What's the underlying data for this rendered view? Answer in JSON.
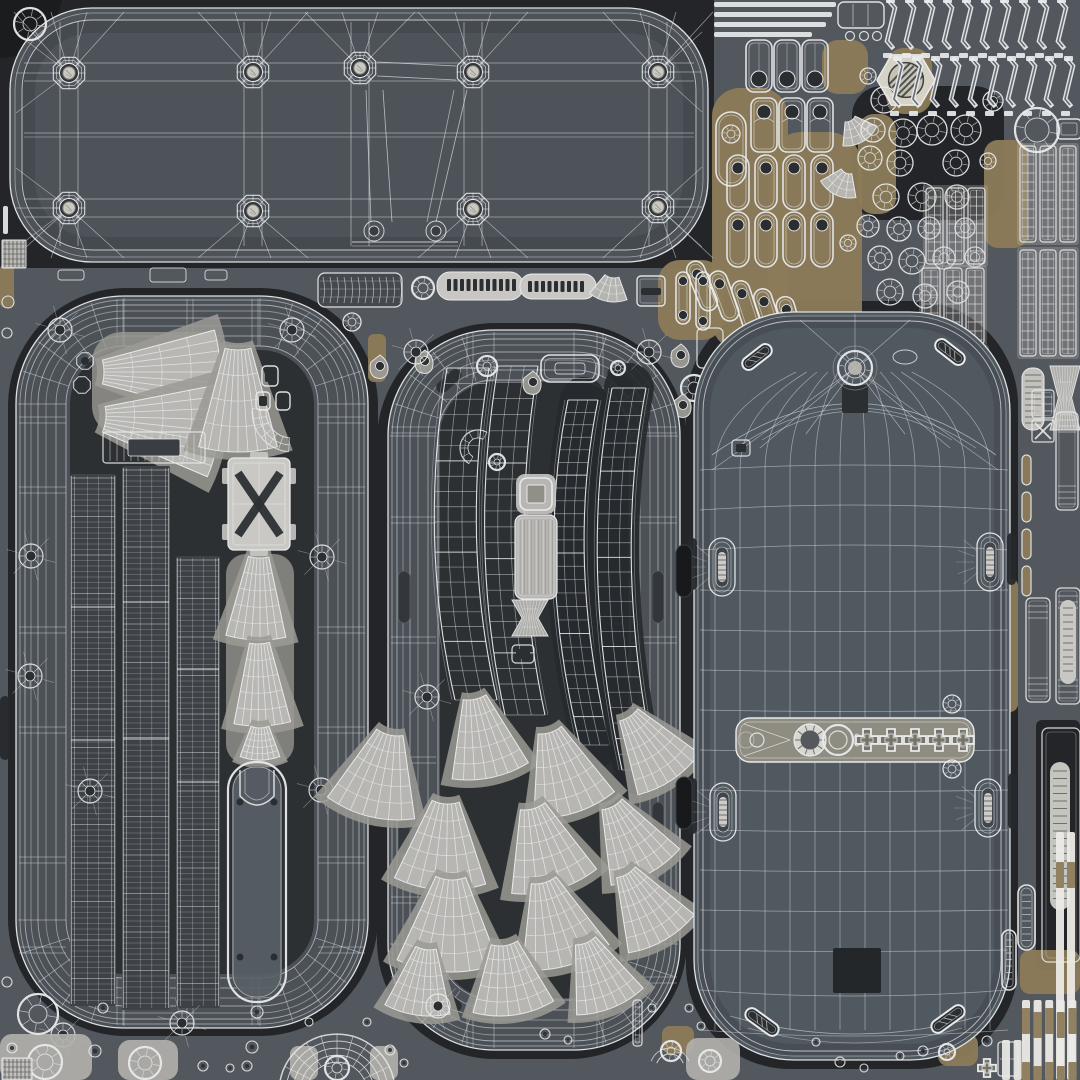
{
  "canvas": {
    "w": 1080,
    "h": 1080
  },
  "palette": {
    "bg": "#53585e",
    "grout": "#232528",
    "groutDeep": "#1a1c1e",
    "band": "#4b5157",
    "interior": "#2d3033",
    "plate": "#4d5359",
    "plateEdge": "#3f4449",
    "shell": "#515960",
    "line": "#e8eaeb",
    "light": "#c8c7c3",
    "mid": "#a8a7a3",
    "patch": "#9b9a94",
    "tan": "#8c7b59",
    "tanDark": "#6f6349",
    "warm": "#8f8c82",
    "mark": "#2c2f32",
    "metal": "#c9c8c1",
    "dark": "#26292c"
  },
  "underlays": [
    [
      0,
      0,
      714,
      268,
      0
    ],
    [
      8,
      288,
      370,
      748,
      118
    ],
    [
      377,
      323,
      310,
      736,
      118
    ],
    [
      686,
      301,
      332,
      768,
      104
    ],
    [
      852,
      86,
      152,
      134,
      30
    ],
    [
      1036,
      720,
      44,
      250,
      6
    ]
  ],
  "tanPatches": [
    [
      712,
      88,
      76,
      262,
      28
    ],
    [
      768,
      132,
      94,
      214,
      34
    ],
    [
      822,
      40,
      46,
      54,
      16
    ],
    [
      858,
      114,
      38,
      100,
      16
    ],
    [
      886,
      48,
      46,
      66,
      18
    ],
    [
      984,
      140,
      44,
      108,
      14
    ],
    [
      658,
      260,
      66,
      80,
      22
    ],
    [
      254,
      316,
      60,
      18,
      8
    ],
    [
      78,
      320,
      38,
      16,
      6
    ],
    [
      1016,
      144,
      12,
      98,
      5
    ],
    [
      998,
      578,
      20,
      134,
      8
    ],
    [
      1020,
      950,
      60,
      44,
      10
    ],
    [
      938,
      1034,
      40,
      32,
      10
    ],
    [
      662,
      1026,
      32,
      28,
      8
    ],
    [
      238,
      738,
      20,
      32,
      6
    ],
    [
      0,
      264,
      14,
      44,
      5
    ],
    [
      368,
      334,
      18,
      48,
      6
    ]
  ],
  "plate": {
    "rect": [
      10,
      8,
      698,
      254,
      82
    ],
    "bossTop": [
      [
        69,
        73
      ],
      [
        253,
        72
      ],
      [
        360,
        68
      ],
      [
        473,
        72
      ],
      [
        658,
        72
      ]
    ],
    "bossBot": [
      [
        69,
        208
      ],
      [
        253,
        211
      ],
      [
        473,
        209
      ],
      [
        658,
        207
      ]
    ],
    "bumps": [
      [
        374,
        231
      ],
      [
        436,
        231
      ]
    ],
    "cornerDonut": [
      30,
      24
    ]
  },
  "topRight": {
    "bars": [
      [
        714,
        2,
        122
      ],
      [
        714,
        12,
        118
      ],
      [
        714,
        22,
        112
      ],
      [
        714,
        32,
        98
      ]
    ],
    "barFrame": [
      838,
      2,
      46,
      26
    ],
    "barCircles": [
      [
        850,
        36
      ],
      [
        864,
        36
      ],
      [
        877,
        36
      ]
    ],
    "framesA": [
      [
        746,
        40
      ],
      [
        774,
        40
      ],
      [
        802,
        40
      ]
    ],
    "framesB": [
      [
        751,
        98
      ],
      [
        779,
        98
      ],
      [
        807,
        98
      ]
    ],
    "capCols": [
      727,
      755,
      783,
      811
    ],
    "capY": 155,
    "tilted": [
      [
        702,
        286,
        -22
      ],
      [
        724,
        296,
        -20
      ],
      [
        746,
        306,
        -18
      ],
      [
        768,
        314,
        -18
      ],
      [
        790,
        322,
        -16
      ]
    ],
    "bigCapsule": [
      716,
      112,
      30,
      74
    ],
    "hex": [
      906,
      80,
      29
    ],
    "fanQuads": [
      [
        846,
        112
      ],
      [
        850,
        164
      ]
    ],
    "rings": [
      [
        884,
        100,
        13
      ],
      [
        873,
        130,
        12
      ],
      [
        903,
        133,
        14
      ],
      [
        870,
        158,
        12
      ],
      [
        900,
        163,
        13
      ],
      [
        932,
        130,
        15
      ],
      [
        966,
        130,
        15
      ],
      [
        956,
        163,
        13
      ],
      [
        922,
        197,
        14
      ],
      [
        886,
        197,
        13
      ],
      [
        957,
        197,
        12
      ],
      [
        993,
        101,
        10
      ],
      [
        988,
        161,
        8
      ],
      [
        868,
        76,
        8
      ],
      [
        868,
        226,
        11
      ],
      [
        899,
        229,
        12
      ],
      [
        929,
        228,
        11
      ],
      [
        965,
        228,
        10
      ],
      [
        880,
        258,
        12
      ],
      [
        912,
        261,
        13
      ],
      [
        944,
        258,
        11
      ],
      [
        975,
        257,
        10
      ],
      [
        890,
        292,
        13
      ],
      [
        925,
        296,
        12
      ],
      [
        958,
        292,
        11
      ],
      [
        848,
        243,
        8
      ]
    ],
    "zigRows": [
      [
        890,
        2,
        54
      ],
      [
        897,
        60,
        112
      ]
    ],
    "zigStep": 19,
    "zigXmax": 1075,
    "ladders": [
      [
        926,
        188,
        3,
        17,
        76
      ],
      [
        922,
        268,
        3,
        18,
        76
      ],
      [
        1020,
        146,
        3,
        16,
        96
      ],
      [
        1020,
        250,
        3,
        16,
        106
      ],
      [
        924,
        348,
        3,
        18,
        60
      ]
    ],
    "bigRing": [
      1037,
      130,
      22,
      12
    ],
    "ringFrame": [
      1057,
      119,
      24,
      20
    ]
  },
  "midStrip": {
    "cyl": [
      318,
      273,
      84,
      34
    ],
    "donut": [
      352,
      322,
      9,
      4
    ],
    "ring": [
      423,
      288,
      11,
      5
    ],
    "ruler": {
      "lobe1": [
        437,
        272,
        86,
        28
      ],
      "lobe2": [
        520,
        274,
        76,
        25
      ],
      "t1x": 447,
      "t1n": 11,
      "t2x": 528,
      "t2n": 9
    },
    "fan": [
      614,
      264,
      14,
      38,
      60,
      10
    ],
    "frame": [
      637,
      276,
      28,
      30
    ],
    "tallCaps": [
      [
        676,
        272,
        14,
        52
      ],
      [
        696,
        272,
        14,
        58
      ]
    ],
    "gapFrame": [
      697,
      328,
      26,
      40
    ],
    "gapRing": [
      694,
      388,
      13,
      6
    ],
    "gapTears": [
      [
        681,
        357
      ],
      [
        683,
        407
      ]
    ]
  },
  "left": {
    "band": [
      16,
      296,
      352,
      732,
      108
    ],
    "bandW": 54,
    "wings": [
      [
        58,
        372,
        46,
        162,
        30,
        -90
      ],
      [
        62,
        415,
        44,
        158,
        34,
        -84
      ],
      [
        238,
        300,
        50,
        152,
        30,
        0
      ]
    ],
    "wingPatch": [
      92,
      332,
      136,
      104,
      30
    ],
    "buttons": [
      [
        262,
        366,
        16,
        20
      ],
      [
        256,
        392,
        14,
        18
      ],
      [
        276,
        392,
        14,
        18
      ]
    ],
    "arcLadder": [
      292,
      412
    ],
    "ladderRect": [
      103,
      432,
      102,
      31
    ],
    "ladderDark": [
      128,
      439,
      52,
      17
    ],
    "xPlate": [
      228,
      458,
      62,
      92
    ],
    "cones": [
      [
        260,
        516,
        42,
        124,
        28,
        2
      ],
      [
        258,
        600,
        44,
        126,
        26,
        -2
      ],
      [
        260,
        702,
        26,
        58,
        40,
        0
      ]
    ],
    "conePatch": [
      226,
      554,
      68,
      210,
      20
    ],
    "battery": [
      228,
      762,
      58,
      240
    ],
    "strips": [
      [
        70,
        474,
        46,
        532
      ],
      [
        122,
        466,
        48,
        544
      ],
      [
        176,
        556,
        44,
        452
      ]
    ],
    "bosses": [
      [
        31,
        556
      ],
      [
        30,
        676
      ],
      [
        90,
        791
      ],
      [
        322,
        557
      ],
      [
        321,
        790
      ],
      [
        60,
        330
      ],
      [
        292,
        330
      ],
      [
        182,
        1023
      ],
      [
        63,
        1035
      ]
    ],
    "octs": [
      [
        85,
        361
      ],
      [
        82,
        385
      ]
    ],
    "ticksY": [
      420,
      490,
      630,
      730,
      860,
      950
    ],
    "ticksX": [
      120,
      190,
      255
    ]
  },
  "center": {
    "band": [
      388,
      330,
      292,
      720,
      106
    ],
    "bandW": 52,
    "slots": [
      [
        398,
        571,
        12,
        52
      ],
      [
        652,
        571,
        12,
        52
      ],
      [
        398,
        802,
        12,
        52
      ],
      [
        652,
        802,
        12,
        52
      ]
    ],
    "cornerSlots": [
      [
        449,
        381,
        -42
      ],
      [
        620,
        379,
        42
      ],
      [
        449,
        1000,
        42
      ],
      [
        620,
        998,
        -42
      ]
    ],
    "bananas": [
      [
        447,
        368,
        418,
        540,
        455,
        700,
        42,
        22,
        0
      ],
      [
        498,
        366,
        468,
        545,
        505,
        715,
        40,
        22,
        0
      ],
      [
        568,
        400,
        535,
        560,
        580,
        745,
        30,
        26,
        1
      ],
      [
        612,
        388,
        578,
        565,
        622,
        770,
        34,
        26,
        1
      ]
    ],
    "topFrame": [
      541,
      355,
      58,
      27
    ],
    "topCircles": [
      [
        487,
        366,
        10,
        4
      ],
      [
        618,
        368,
        7,
        3
      ],
      [
        497,
        462,
        8,
        3
      ]
    ],
    "tears": [
      [
        425,
        363
      ],
      [
        533,
        384
      ],
      [
        380,
        368
      ]
    ],
    "cArc": [
      478,
      448
    ],
    "sqFrame": [
      520,
      478,
      32,
      32
    ],
    "lightRect": [
      515,
      515,
      42,
      84
    ],
    "hourglass": [
      512,
      600,
      36,
      36
    ],
    "smallFrame": [
      512,
      645,
      22,
      18
    ],
    "fans": [
      [
        468,
        666,
        34,
        114,
        40,
        -12
      ],
      [
        398,
        700,
        36,
        120,
        44,
        14
      ],
      [
        540,
        700,
        34,
        118,
        42,
        -18
      ],
      [
        612,
        690,
        32,
        108,
        40,
        -34
      ],
      [
        448,
        768,
        36,
        122,
        44,
        4
      ],
      [
        524,
        776,
        34,
        118,
        44,
        -16
      ],
      [
        598,
        778,
        32,
        108,
        42,
        -28
      ],
      [
        452,
        842,
        38,
        130,
        46,
        2
      ],
      [
        535,
        850,
        34,
        120,
        44,
        -16
      ],
      [
        612,
        848,
        30,
        106,
        42,
        -30
      ],
      [
        500,
        912,
        34,
        104,
        46,
        -8
      ],
      [
        575,
        915,
        30,
        100,
        42,
        -22
      ],
      [
        430,
        920,
        30,
        96,
        40,
        8
      ]
    ],
    "bosses": [
      [
        416,
        352
      ],
      [
        649,
        352
      ],
      [
        427,
        697
      ],
      [
        438,
        1006
      ]
    ],
    "ticksY": [
      430,
      520,
      640,
      760,
      900,
      980
    ]
  },
  "right": {
    "shell": [
      694,
      312,
      316,
      748,
      100
    ],
    "gridX": [
      715,
      740,
      765,
      790,
      815,
      840,
      865,
      890,
      915,
      940,
      965,
      990
    ],
    "gridY0": 470,
    "gridY1": 1030,
    "gridStep": 40,
    "domeC": [
      855,
      368
    ],
    "topSlots": [
      [
        757,
        357,
        -38
      ],
      [
        950,
        352,
        38
      ]
    ],
    "topOval": [
      905,
      357,
      12,
      7
    ],
    "darkSq": [
      842,
      385,
      26,
      28
    ],
    "notchRect": [
      732,
      440,
      18,
      16
    ],
    "ovals": [
      [
        722,
        567
      ],
      [
        990,
        562
      ],
      [
        723,
        812
      ],
      [
        988,
        808
      ]
    ],
    "edgeNotches": [
      [
        688,
        538,
        9,
        52
      ],
      [
        1007,
        533,
        9,
        52
      ],
      [
        688,
        778,
        9,
        56
      ],
      [
        1008,
        773,
        9,
        56
      ]
    ],
    "strip": [
      736,
      718,
      238,
      44
    ],
    "stripGear": [
      810,
      740
    ],
    "stripRing": [
      838,
      740
    ],
    "stripDot": [
      757,
      740
    ],
    "crosses": [
      867,
      891,
      915,
      939,
      963
    ],
    "sideDonuts": [
      [
        952,
        704,
        9,
        4
      ],
      [
        952,
        769,
        9,
        4
      ]
    ],
    "darkRect": [
      833,
      948,
      48,
      45
    ],
    "botSlots": [
      [
        762,
        1022,
        36
      ],
      [
        948,
        1019,
        -36
      ]
    ],
    "gapSlots": [
      [
        676,
        545,
        16,
        52
      ],
      [
        676,
        777,
        16,
        52
      ]
    ]
  },
  "edge": {
    "capFrames": [
      [
        1022,
        368,
        22,
        62
      ]
    ],
    "hourglass": [
      1050,
      366,
      30,
      64
    ],
    "smallCaps": [
      [
        1022,
        455
      ],
      [
        1022,
        492
      ],
      [
        1022,
        529
      ],
      [
        1022,
        566
      ]
    ],
    "xBox": [
      1032,
      420,
      22,
      22
    ],
    "ladder1": [
      1032,
      390,
      22,
      28
    ],
    "tallFrames": [
      [
        1056,
        412,
        22,
        98
      ],
      [
        1026,
        598,
        24,
        104
      ],
      [
        1056,
        588,
        24,
        116
      ]
    ],
    "innerCaps": [
      [
        1060,
        600,
        16,
        84
      ]
    ],
    "botFrame": [
      1042,
      728,
      38,
      234
    ],
    "botCap": [
      1050,
      762,
      20,
      148
    ],
    "sideCaps": [
      [
        1018,
        885,
        17,
        65
      ],
      [
        1002,
        930,
        14,
        60
      ]
    ],
    "strips": {
      "x0": 1022,
      "y0": 1000,
      "n": 5,
      "w": 8,
      "gap": 3.6,
      "tanBands": [
        [
          1008,
          26
        ],
        [
          1062,
          20
        ]
      ]
    },
    "longStrips": [
      [
        1056,
        832
      ],
      [
        1067,
        832
      ]
    ],
    "longTan": [
      862,
      26
    ],
    "stripsB": {
      "x0": 1002,
      "y0": 1040,
      "n": 2,
      "w": 8,
      "gap": 3.6
    }
  },
  "bottom": {
    "patches": [
      [
        0,
        1034,
        92,
        46,
        12
      ],
      [
        118,
        1040,
        60,
        40,
        12
      ],
      [
        290,
        1046,
        28,
        34,
        8
      ],
      [
        370,
        1046,
        28,
        34,
        8
      ],
      [
        686,
        1038,
        54,
        42,
        12
      ]
    ],
    "bigDonuts": [
      [
        38,
        1014,
        20,
        9
      ],
      [
        45,
        1062,
        17,
        8
      ],
      [
        145,
        1063,
        16,
        7
      ],
      [
        337,
        1068,
        12,
        5
      ],
      [
        671,
        1051,
        10,
        4
      ],
      [
        710,
        1061,
        11,
        5
      ],
      [
        947,
        1052,
        8,
        3
      ]
    ],
    "smallCircles": [
      [
        12,
        1048,
        5
      ],
      [
        95,
        1051,
        6
      ],
      [
        103,
        1008,
        5
      ],
      [
        203,
        1066,
        5
      ],
      [
        230,
        1068,
        4
      ],
      [
        257,
        1012,
        6
      ],
      [
        252,
        1047,
        6
      ],
      [
        247,
        1066,
        5
      ],
      [
        309,
        1022,
        4
      ],
      [
        367,
        1022,
        4
      ],
      [
        390,
        1050,
        5
      ],
      [
        404,
        1063,
        4
      ],
      [
        545,
        1034,
        5
      ],
      [
        568,
        1040,
        4
      ],
      [
        652,
        1008,
        4
      ],
      [
        689,
        1008,
        4
      ],
      [
        701,
        1026,
        4
      ],
      [
        816,
        1042,
        4
      ],
      [
        840,
        1062,
        5
      ],
      [
        864,
        1068,
        4
      ],
      [
        900,
        1056,
        4
      ],
      [
        923,
        1051,
        5
      ],
      [
        987,
        1041,
        5
      ]
    ],
    "arch": [
      337,
      1092
    ],
    "vBar": [
      633,
      1000,
      9,
      46
    ],
    "cross": [
      987,
      1068
    ],
    "gridFrame": [
      998,
      1042,
      20,
      34
    ],
    "hatch": [
      2,
      1058,
      30,
      22
    ],
    "leftEdge": {
      "bar": [
        3,
        206,
        5,
        28
      ],
      "hatch": [
        2,
        240,
        24,
        28
      ],
      "circles": [
        [
          8,
          302,
          6
        ],
        [
          7,
          333,
          5
        ],
        [
          7,
          982,
          5
        ]
      ],
      "slot": [
        0,
        696,
        10,
        64
      ]
    },
    "underPlate": [
      [
        58,
        270,
        26,
        10
      ],
      [
        150,
        268,
        36,
        14
      ],
      [
        205,
        270,
        22,
        10
      ]
    ]
  }
}
